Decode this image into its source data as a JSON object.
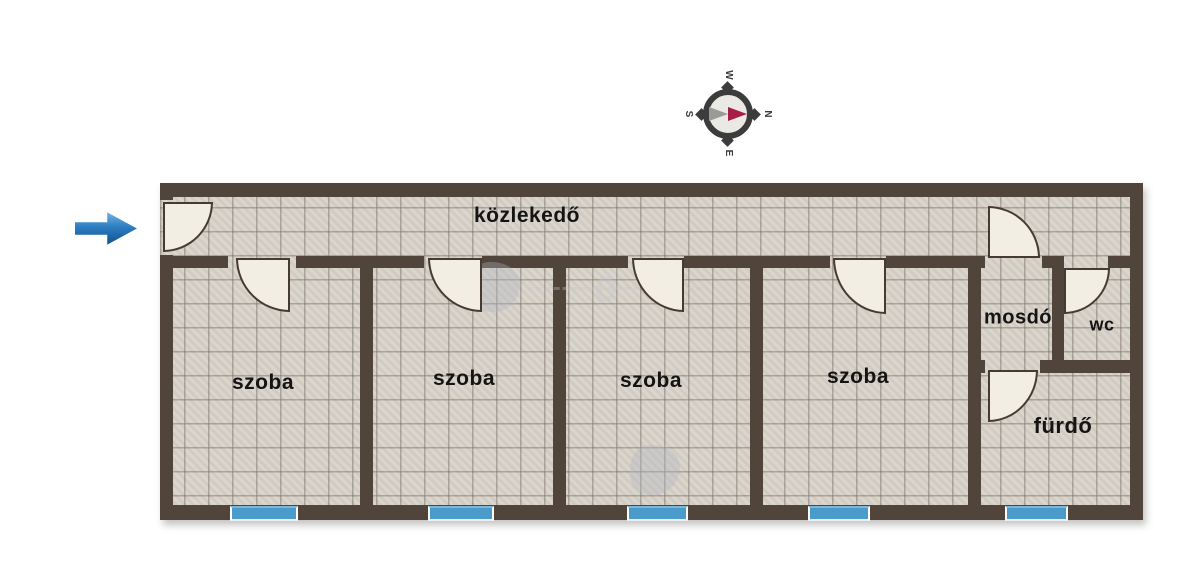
{
  "plan": {
    "corridor": {
      "label": "közlekedő"
    },
    "rooms": [
      {
        "label": "szoba"
      },
      {
        "label": "szoba"
      },
      {
        "label": "szoba"
      },
      {
        "label": "szoba"
      }
    ],
    "wet_rooms": {
      "mosdo": "mosdó",
      "wc": "wc",
      "furdo": "fürdő"
    },
    "colors": {
      "wall": "#51443a",
      "floor_tile": "#d8d2c9",
      "tile_grid": "#7a7269",
      "door_leaf": "#f3eee3",
      "window_blue": "#4a9aca",
      "entrance_arrow_blue": "#0d4e8e",
      "compass_needle_red": "#a81d46"
    }
  },
  "compass": {
    "north": "N",
    "east": "E",
    "south": "S",
    "west": "W"
  }
}
